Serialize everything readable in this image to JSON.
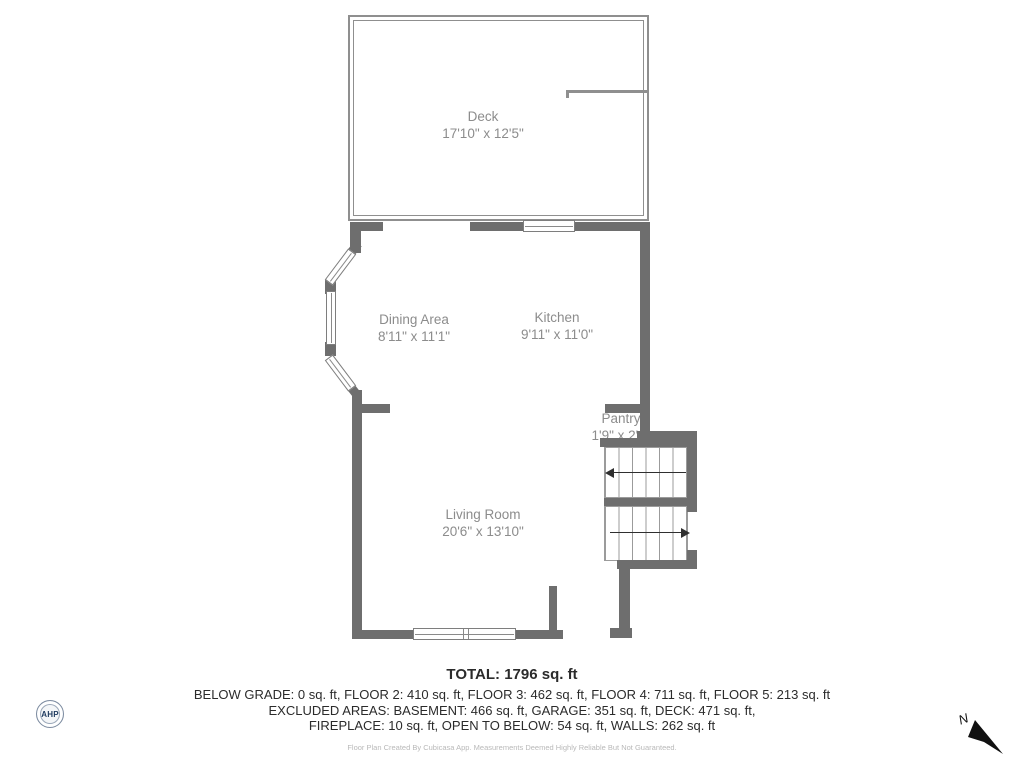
{
  "plan": {
    "rooms": {
      "deck": {
        "name": "Deck",
        "dims": "17'10\" x 12'5\""
      },
      "dining": {
        "name": "Dining Area",
        "dims": "8'11\" x 11'1\""
      },
      "kitchen": {
        "name": "Kitchen",
        "dims": "9'11\" x 11'0\""
      },
      "pantry": {
        "name": "Pantry",
        "dims": "1'9\" x 2'1\""
      },
      "living": {
        "name": "Living Room",
        "dims": "20'6\" x 13'10\""
      }
    }
  },
  "summary": {
    "total": "TOTAL: 1796 sq. ft",
    "line1": "BELOW GRADE: 0 sq. ft, FLOOR 2: 410 sq. ft, FLOOR 3: 462 sq. ft, FLOOR 4: 711 sq. ft, FLOOR 5: 213 sq. ft",
    "line2": "EXCLUDED AREAS: BASEMENT: 466 sq. ft, GARAGE: 351 sq. ft, DECK: 471 sq. ft,",
    "line3": "FIREPLACE: 10 sq. ft, OPEN TO BELOW: 54 sq. ft, WALLS: 262 sq. ft"
  },
  "footer": "Floor Plan Created By Cubicasa App. Measurements Deemed Highly Reliable But Not Guaranteed.",
  "logo_text": "AHP",
  "compass_label": "N",
  "colors": {
    "wall": "#6e6e6e",
    "thin": "#8f8f8f",
    "label": "#8c8c8c",
    "summary": "#2b2b2b",
    "footer": "#b9b9b9",
    "logo": "#1e3a5f"
  }
}
